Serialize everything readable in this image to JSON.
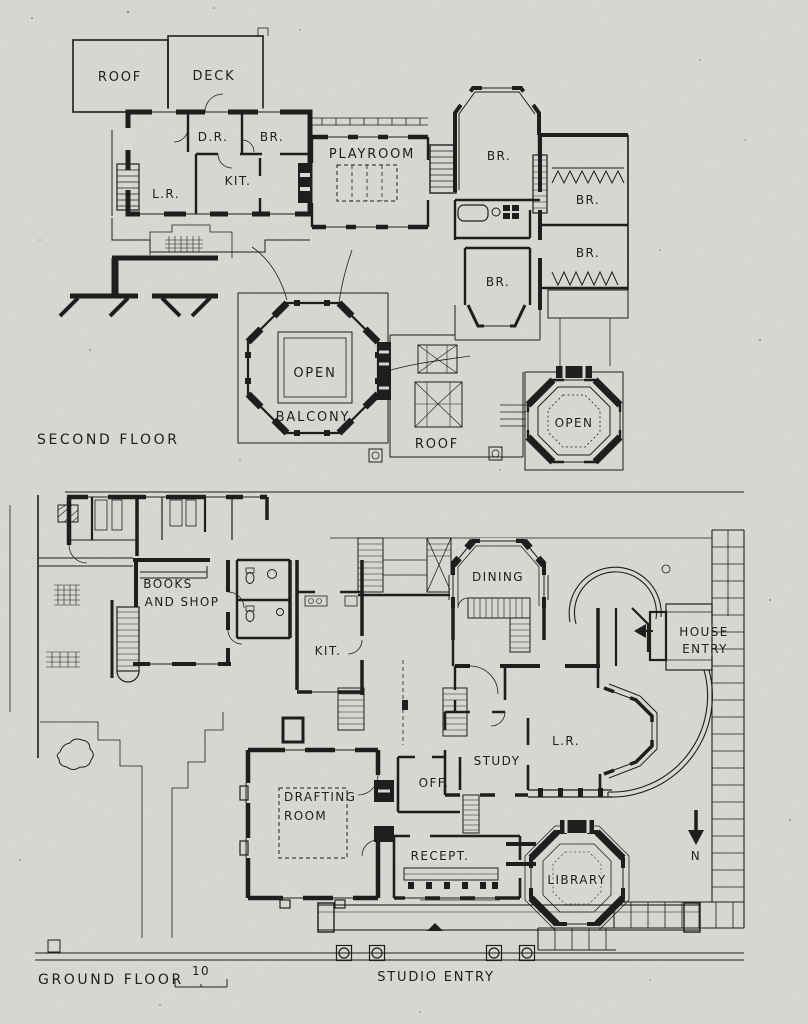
{
  "colors": {
    "paper": "#d9d8d3",
    "ink": "#1e1e1e"
  },
  "second_floor": {
    "title": "SECOND FLOOR",
    "labels": {
      "roof": "ROOF",
      "deck": "DECK",
      "dr": "D.R.",
      "br_a": "BR.",
      "lr": "L.R.",
      "kit": "KIT.",
      "playroom": "PLAYROOM",
      "br_b": "BR.",
      "br_c": "BR.",
      "br_d": "BR.",
      "br_e": "BR.",
      "open_balcony": "OPEN",
      "balcony": "BALCONY",
      "roof_flat": "ROOF",
      "open_octagon": "OPEN"
    }
  },
  "ground_floor": {
    "title": "GROUND FLOOR",
    "scale_number": "10",
    "labels": {
      "books_1": "BOOKS",
      "books_2": "AND SHOP",
      "kit": "KIT.",
      "dining": "DINING",
      "house_entry_1": "HOUSE",
      "house_entry_2": "ENTRY",
      "lr": "L.R.",
      "study": "STUDY",
      "office": "OFF.",
      "drafting_1": "DRAFTING",
      "drafting_2": "ROOM",
      "recept": "RECEPT.",
      "library": "LIBRARY",
      "studio_entry": "STUDIO ENTRY",
      "north": "N"
    }
  }
}
